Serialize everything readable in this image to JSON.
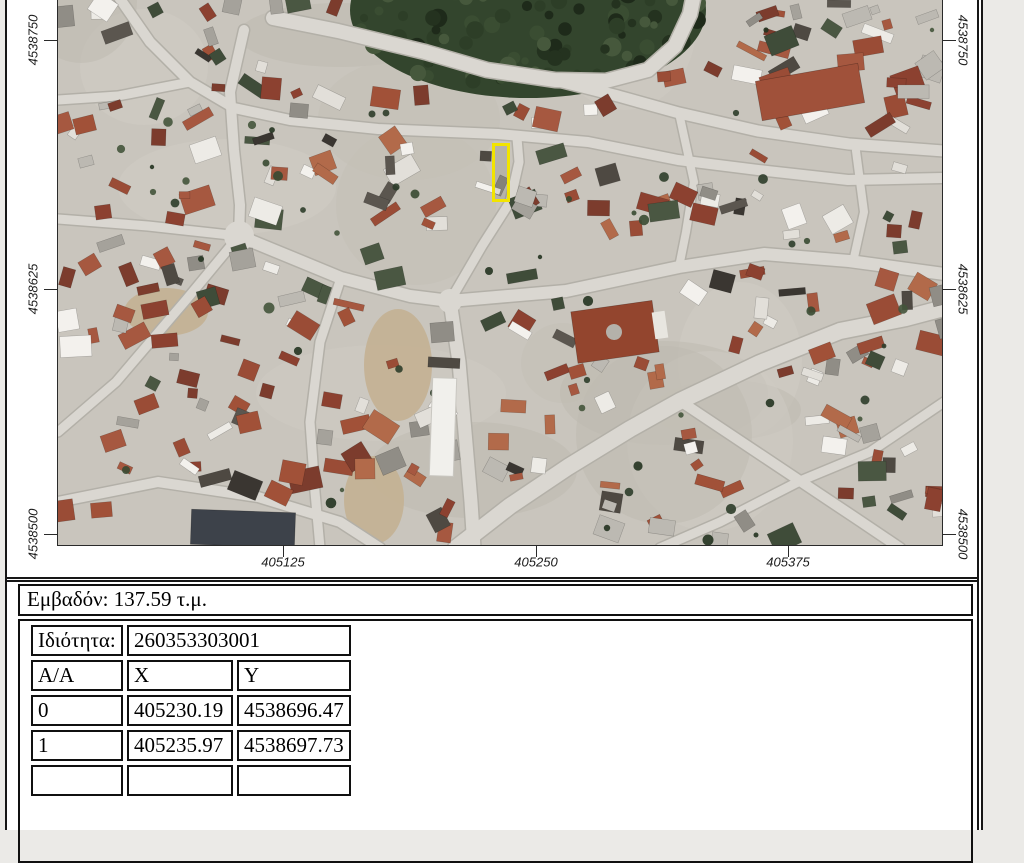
{
  "window": {
    "page_background": "#ffffff",
    "desk_background": "#ebeae7",
    "border_color": "#161616"
  },
  "map": {
    "description": "aerial-orthophoto-of-town",
    "highlight": {
      "note": "selected-parcel",
      "color": "#f2e400",
      "x": 435,
      "y": 144,
      "w": 15,
      "h": 56
    },
    "grid": {
      "left_labels": [
        {
          "text": "4538750",
          "y": 40
        },
        {
          "text": "4538625",
          "y": 289
        },
        {
          "text": "4538500",
          "y": 534
        }
      ],
      "right_labels": [
        {
          "text": "4538750",
          "y": 40
        },
        {
          "text": "4538625",
          "y": 289
        },
        {
          "text": "4538500",
          "y": 534
        }
      ],
      "bottom_labels": [
        {
          "text": "405125",
          "x": 276
        },
        {
          "text": "405250",
          "x": 529
        },
        {
          "text": "405375",
          "x": 781
        }
      ]
    }
  },
  "info": {
    "area_text": "Εμβαδόν: 137.59 τ.μ."
  },
  "coords": {
    "property_label": "Ιδιότητα:",
    "property_value": "260353303001",
    "headers": [
      "A/A",
      "X",
      "Y"
    ],
    "rows": [
      [
        "0",
        "405230.19",
        "4538696.47"
      ],
      [
        "1",
        "405235.97",
        "4538697.73"
      ]
    ]
  }
}
